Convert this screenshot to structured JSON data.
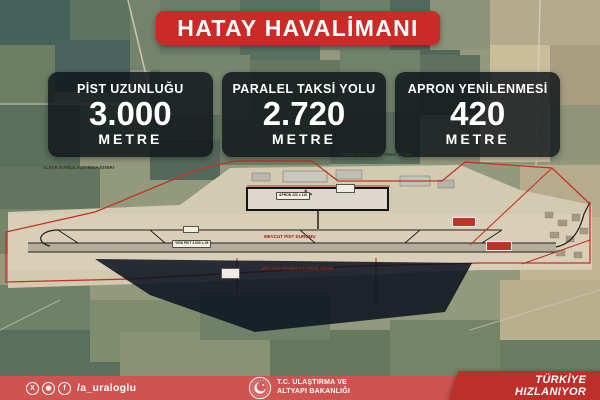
{
  "title": "HATAY HAVALİMANI",
  "stats": [
    {
      "label": "PİST UZUNLUĞU",
      "value": "3.000",
      "unit": "METRE"
    },
    {
      "label": "PARALEL TAKSİ YOLU",
      "value": "2.720",
      "unit": "METRE"
    },
    {
      "label": "APRON YENİLENMESİ",
      "value": "420",
      "unit": "METRE"
    }
  ],
  "map": {
    "labels": [
      {
        "text": "İLAVE KAMULAŞTIRMA SINIRI"
      },
      {
        "text": "İLAVE KAMULAŞTIRMA SINIRI"
      },
      {
        "text": "MEVCUT PİST DURUMU"
      },
      {
        "text": "MEVCUT KAMULAŞTIRMA SINIRI"
      },
      {
        "text": "YENİ PİST 3.000 x 45"
      },
      {
        "text": "APRON 420 x 110"
      }
    ]
  },
  "footer": {
    "handle": "/a_uraloglu",
    "icons": {
      "x": "X",
      "instagram": "◉",
      "facebook": "f"
    },
    "ministry_line1": "T.C. ULAŞTIRMA VE",
    "ministry_line2": "ALTYAPI BAKANLIĞI",
    "slogan_line1": "TÜRKİYE",
    "slogan_line2": "HIZLANIYOR"
  },
  "colors": {
    "banner_red": "#cb2b26",
    "footer_red": "#cd5450",
    "slogan_red": "#bd2f2a",
    "boundary_red": "#c23325",
    "card_bg": "rgba(13,18,24,0.82)"
  }
}
